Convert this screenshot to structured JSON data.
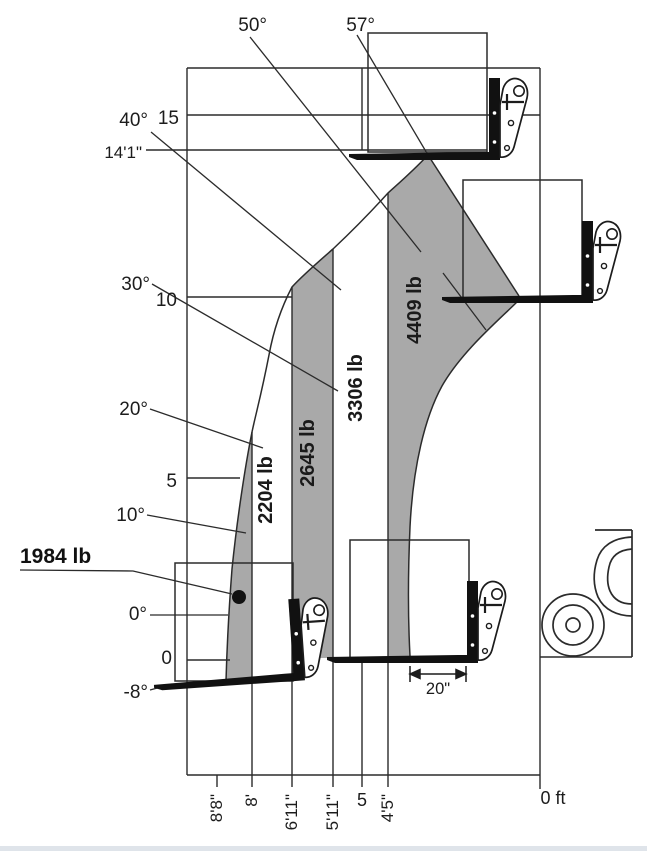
{
  "diagram": {
    "angle_labels": [
      "57°",
      "50°",
      "40°",
      "30°",
      "20°",
      "10°",
      "0°",
      "-8°"
    ],
    "height_ticks": [
      "15",
      "10",
      "5",
      "0"
    ],
    "max_height_label": "14'1\"",
    "capacity_labels": [
      "1984 lb",
      "2204 lb",
      "2645 lb",
      "3306 lb",
      "4409 lb"
    ],
    "reach_labels": [
      "8'8\"",
      "8'",
      "6'11\"",
      "5'11\"",
      "5",
      "4'5\"",
      "0 ft"
    ],
    "load_center_label": "20\"",
    "colors": {
      "zone_fill": "#a9a9a9",
      "line": "#2b2b2b"
    }
  },
  "zones": [
    {
      "capacity_lb": 1984,
      "outer_reach": "8'8\""
    },
    {
      "capacity_lb": 2204,
      "outer_reach": "8'"
    },
    {
      "capacity_lb": 2645,
      "outer_reach": "6'11\""
    },
    {
      "capacity_lb": 3306,
      "outer_reach": "5'11\""
    },
    {
      "capacity_lb": 4409,
      "outer_reach": "4'5\""
    }
  ]
}
